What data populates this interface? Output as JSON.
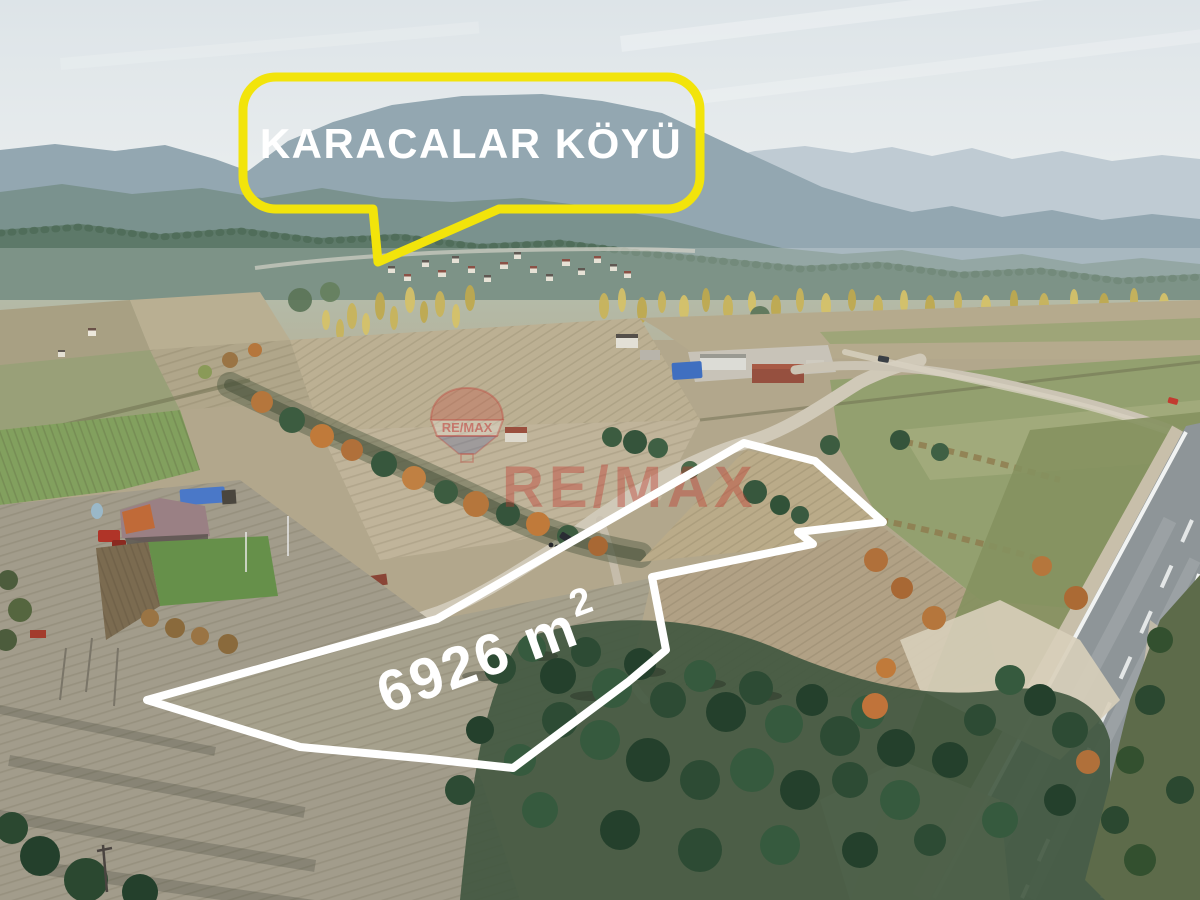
{
  "annotations": {
    "village_callout": {
      "text": "KARACALAR KÖYÜ",
      "bubble_color": "#F2E40B",
      "text_color": "#FFFFFF"
    },
    "parcel": {
      "area_text": "6926 m",
      "area_sup": "2",
      "outline_color": "#FFFFFF"
    },
    "watermark": {
      "brand_text": "RE/MAX",
      "balloon_text": "RE/MAX",
      "color": "#C23A36"
    }
  }
}
